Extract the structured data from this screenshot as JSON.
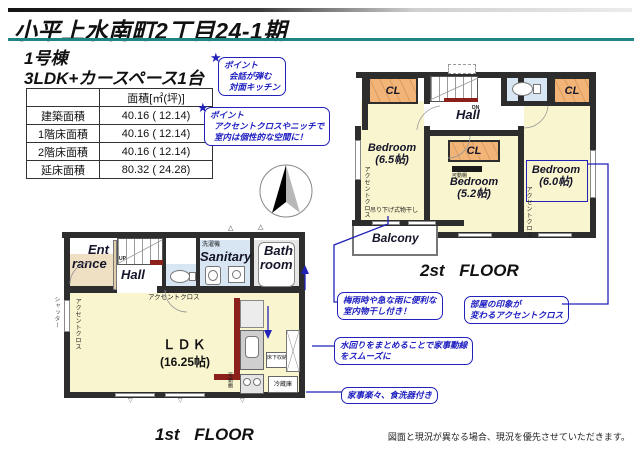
{
  "header": {
    "title": "小平上水南町2丁目24-1期",
    "building": "1号棟",
    "layout": "3LDK+カースペース1台"
  },
  "area_table": {
    "header": "面積[㎡(坪)]",
    "rows": [
      {
        "label": "建築面積",
        "value": "40.16 ( 12.14)"
      },
      {
        "label": "1階床面積",
        "value": "40.16 ( 12.14)"
      },
      {
        "label": "2階床面積",
        "value": "40.16 ( 12.14)"
      },
      {
        "label": "延床面積",
        "value": "80.32 ( 24.28)"
      }
    ]
  },
  "points": [
    {
      "title": "ポイント",
      "line1": "会話が弾む",
      "line2": "対面キッチン"
    },
    {
      "title": "ポイント",
      "line1": "アクセントクロスやニッチで",
      "line2": "室内は個性的な空間に！"
    }
  ],
  "annotations": [
    {
      "line1": "梅雨時や急な雨に便利な",
      "line2": "室内物干し付き！"
    },
    {
      "line1": "部屋の印象が",
      "line2": "変わるアクセントクロス"
    },
    {
      "line1": "水回りをまとめることで家事動線",
      "line2": "をスムーズに"
    },
    {
      "line1": "家事楽々、食洗器付き",
      "line2": ""
    }
  ],
  "floor2": {
    "label": "2st FLOOR",
    "hall": "Hall",
    "dn": "DN",
    "cl1": "CL",
    "cl2": "CL",
    "cl3": "CL",
    "bedroom1_name": "Bedroom",
    "bedroom1_size": "(6.5帖)",
    "bedroom2_name": "Bedroom",
    "bedroom2_size": "(5.2帖)",
    "bedroom3_name": "Bedroom",
    "bedroom3_size": "(6.0帖)",
    "balcony": "Balcony",
    "hanging": "吊り下げ式物干し",
    "movable_shelf": "可動棚",
    "accent_left": "アクセントクロス",
    "accent_right": "アクセントクロス"
  },
  "floor1": {
    "label": "1st FLOOR",
    "ent1": "Ent",
    "ent2": "rance",
    "hall": "Hall",
    "up": "UP",
    "sanitary": "Sanitary",
    "washer": "洗濯機",
    "bath1": "Bath",
    "bath2": "room",
    "ldk": "ＬＤＫ",
    "ldk_size": "(16.25帖)",
    "accent_toilet": "アクセントクロス",
    "accent_wall": "アクセントクロス",
    "shutter": "シャッター",
    "movable_shelf": "可動棚",
    "underfloor": "床下収納",
    "fridge": "冷蔵庫"
  },
  "footer": {
    "disclaimer": "図面と現況が異なる場合、現況を優先させていただきます。"
  },
  "icons": {
    "star": "★",
    "vent": "△",
    "window_mark": "▽"
  },
  "colors": {
    "teal_rule": "#1e8585",
    "wall": "#2d2d2d",
    "room_yellow": "#f9f6cf",
    "closet_orange": "#f3b577",
    "wet_blue": "#d8e6f3",
    "entrance_tan": "#efe0c3",
    "accent_dark_red": "#8b1f1a",
    "annotation_blue": "#2222bb"
  }
}
